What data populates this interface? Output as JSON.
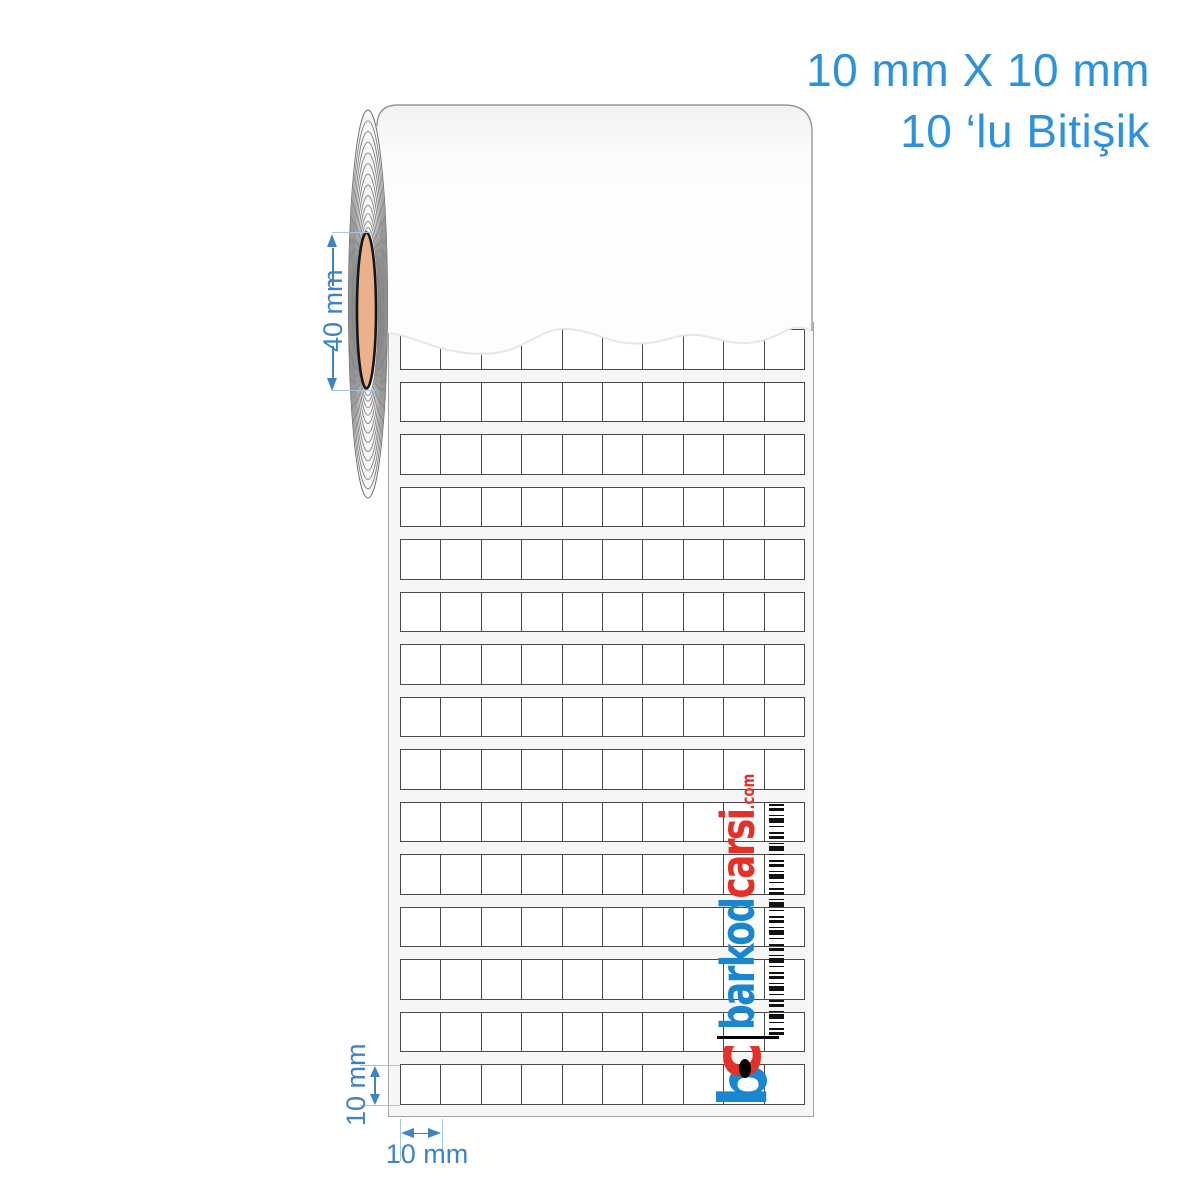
{
  "caption": {
    "line1": "10 mm X 10 mm",
    "line2": "10 ‘lu Bitişik"
  },
  "dimensions": {
    "core_diameter_label": "40 mm",
    "label_height_label": "10 mm",
    "label_width_label": "10 mm"
  },
  "grid": {
    "columns": 10,
    "rows": 15
  },
  "logo": {
    "icon_letter_b": "b",
    "icon_letter_c": "c",
    "name_primary": "barkod",
    "name_secondary": "carsi",
    "tld": ".com"
  },
  "colors": {
    "accent_blue": "#2b92db",
    "dimension_blue": "#3f83c6",
    "guide_blue": "#a6c6e6",
    "logo_blue": "#1b86d0",
    "logo_red": "#e43028",
    "core_tan": "#ebb18c",
    "cell_border": "#4a4a4a",
    "liner_bg": "#f6f6f6",
    "edge_grey": "#979797"
  }
}
